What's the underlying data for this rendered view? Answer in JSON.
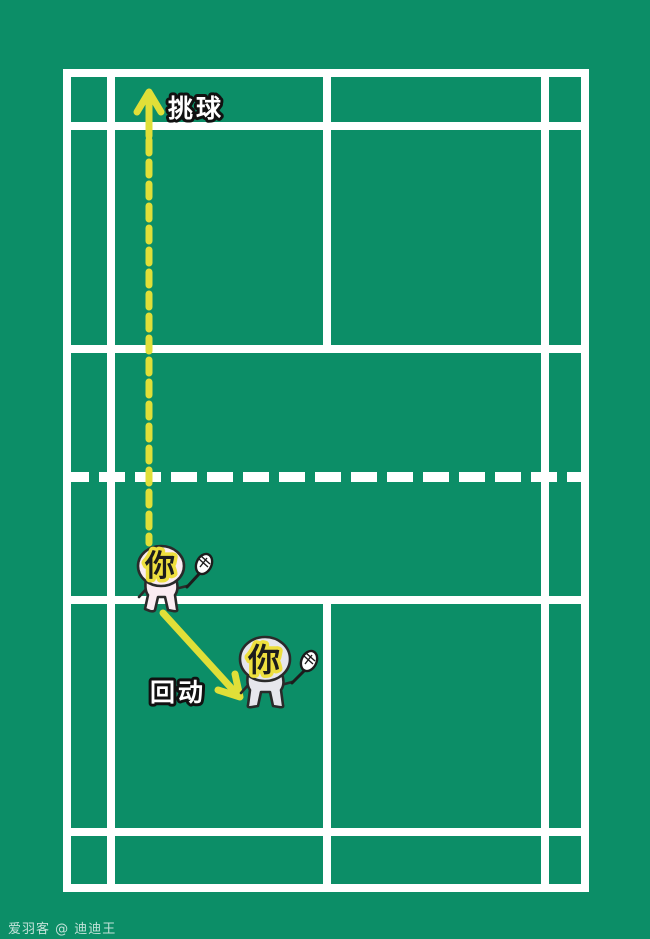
{
  "annotations": {
    "lob_label": "挑球",
    "recover_label": "回动"
  },
  "players": {
    "upper": {
      "label": "你"
    },
    "lower": {
      "label": "你"
    }
  },
  "watermark": "爱羽客 @ 迪迪王",
  "colors": {
    "court_green": "#0c8e67",
    "line_white": "#ffffff",
    "arrow_yellow": "#e0df38",
    "player_upper_fill": "#fbecf2",
    "player_lower_fill": "#e6e6ec",
    "racket_fill": "#ffffff",
    "outline_dark": "#2a2a2a",
    "char_fill": "#1c1c1c",
    "char_halo": "#eedf3e",
    "label_fill": "#ffffff",
    "label_outline": "#111111"
  }
}
